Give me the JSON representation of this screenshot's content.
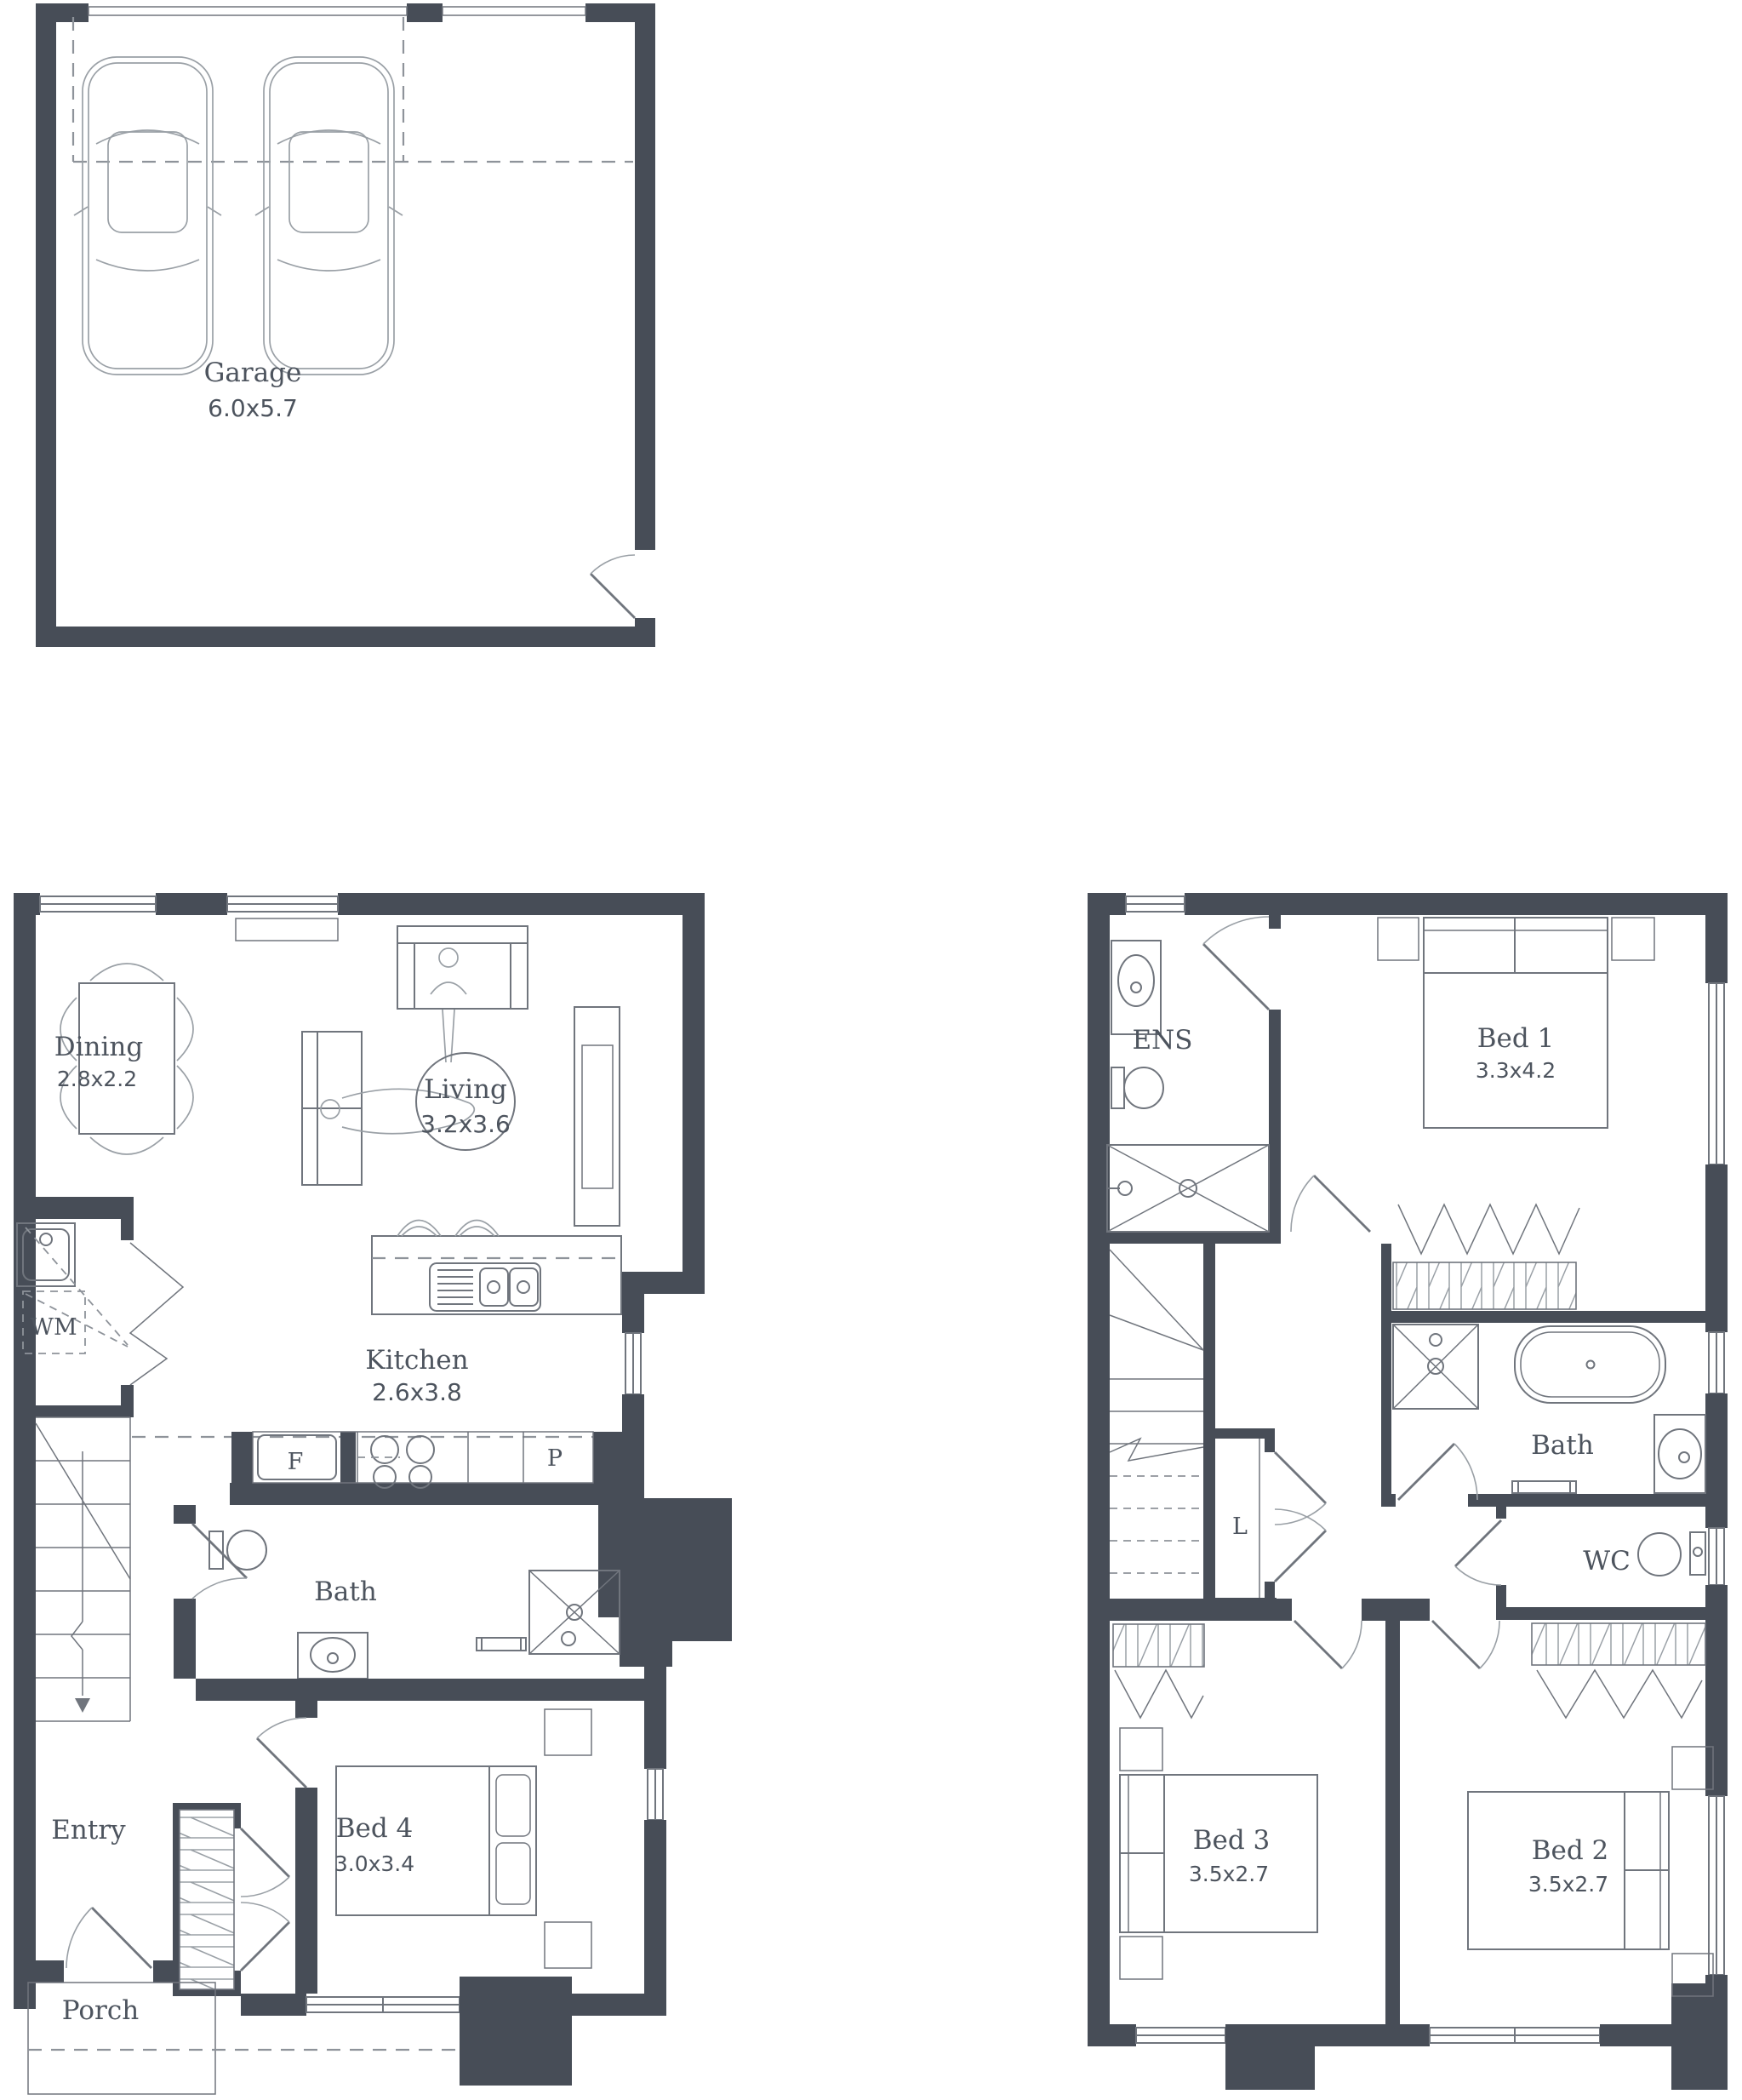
{
  "title": "Townhouse floor plan",
  "colors": {
    "wall": "#474d57",
    "line": "#70757d",
    "light": "#9aa0a6",
    "text": "#4d545e",
    "dashc": "#8e939a",
    "bg": "#ffffff"
  },
  "garage": {
    "label": "Garage",
    "dims": "6.0x5.7"
  },
  "ground_floor": {
    "dining": {
      "label": "Dining",
      "dims": "2.8x2.2"
    },
    "living": {
      "label": "Living",
      "dims": "3.2x3.6"
    },
    "kitchen": {
      "label": "Kitchen",
      "dims": "2.6x3.8",
      "fridge": "F",
      "pantry": "P"
    },
    "laundry": {
      "wm": "WM"
    },
    "bath": {
      "label": "Bath"
    },
    "bed4": {
      "label": "Bed 4",
      "dims": "3.0x3.4"
    },
    "entry": {
      "label": "Entry"
    },
    "porch": {
      "label": "Porch"
    }
  },
  "first_floor": {
    "ens": {
      "label": "ENS"
    },
    "bed1": {
      "label": "Bed 1",
      "dims": "3.3x4.2"
    },
    "bath": {
      "label": "Bath"
    },
    "linen": {
      "label": "L"
    },
    "wc": {
      "label": "WC"
    },
    "bed3": {
      "label": "Bed 3",
      "dims": "3.5x2.7"
    },
    "bed2": {
      "label": "Bed 2",
      "dims": "3.5x2.7"
    }
  }
}
